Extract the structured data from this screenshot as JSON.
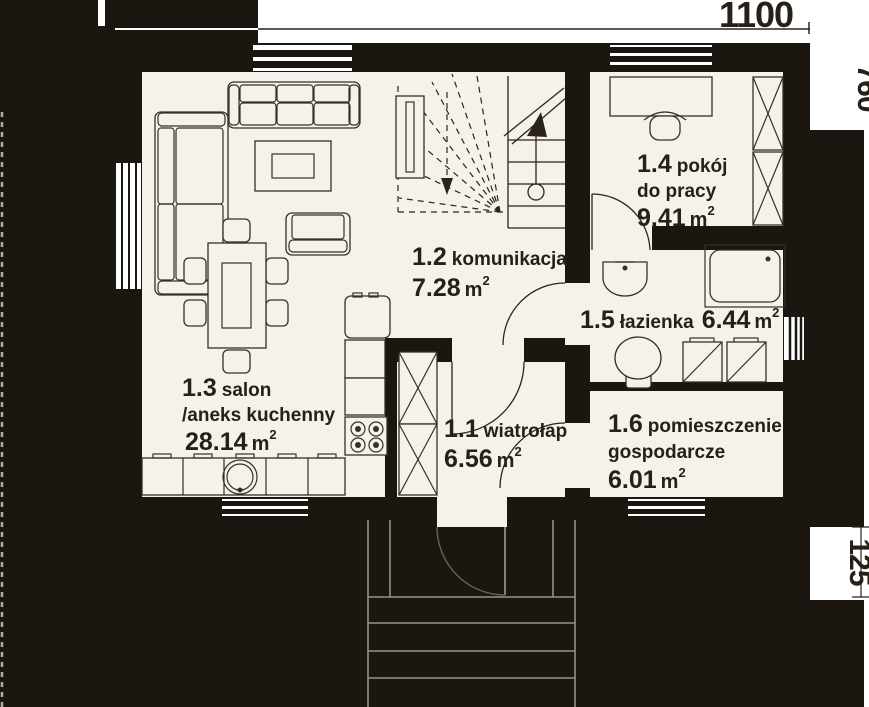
{
  "title": "house-ground-floor-plan",
  "dimensions": {
    "width": "1100",
    "right_upper": "760",
    "right_lower": "125"
  },
  "rooms": [
    {
      "id": "1.1",
      "name": "wiatrołap",
      "name2": "",
      "area": "6.56",
      "unit": "m",
      "sup": "2"
    },
    {
      "id": "1.2",
      "name": "komunikacja",
      "name2": "",
      "area": "7.28",
      "unit": "m",
      "sup": "2"
    },
    {
      "id": "1.3",
      "name": "salon",
      "name2": "/aneks kuchenny",
      "area": "28.14",
      "unit": "m",
      "sup": "2"
    },
    {
      "id": "1.4",
      "name": "pokój",
      "name2": "do pracy",
      "area": "9.41",
      "unit": "m",
      "sup": "2"
    },
    {
      "id": "1.5",
      "name": "łazienka",
      "name2": "",
      "area": "6.44",
      "unit": "m",
      "sup": "2"
    },
    {
      "id": "1.6",
      "name": "pomieszczenie",
      "name2": "gospodarcze",
      "area": "6.01",
      "unit": "m",
      "sup": "2"
    }
  ],
  "colors": {
    "wall": "#1b1610",
    "floor": "#f6f1ea",
    "line": "#2b241c",
    "text": "#262019",
    "paper": "#ffffff"
  }
}
